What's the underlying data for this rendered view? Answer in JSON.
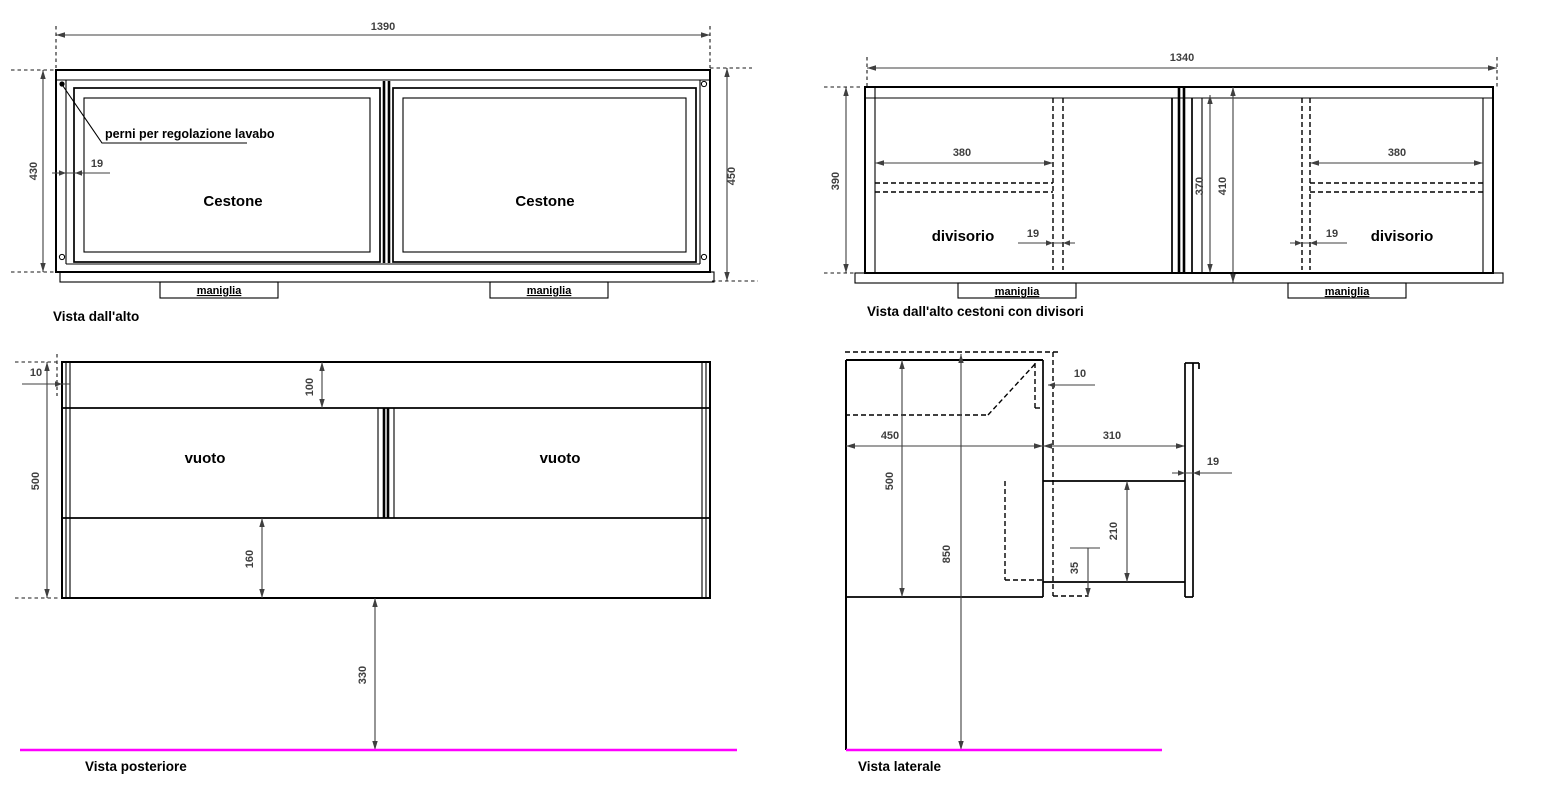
{
  "colors": {
    "line": "#000000",
    "dimension": "#3f3f3f",
    "floor_line": "#ff00ff",
    "background": "#ffffff"
  },
  "views": {
    "top_plan": {
      "title": "Vista dall'alto",
      "note": "perni per regolazione lavabo",
      "drawer_label": "Cestone",
      "handle_label": "maniglia",
      "dims": {
        "overall_width": "1390",
        "depth_inner": "430",
        "depth_outer": "450",
        "panel_thickness": "19"
      }
    },
    "top_plan_dividers": {
      "title": "Vista dall'alto cestoni con divisori",
      "divider_label": "divisorio",
      "handle_label": "maniglia",
      "dims": {
        "overall_width": "1340",
        "depth_left": "390",
        "depth_inner": "370",
        "depth_outer": "410",
        "divider_offset": "380",
        "divider_thickness": "19"
      }
    },
    "rear": {
      "title": "Vista posteriore",
      "empty_label": "vuoto",
      "dims": {
        "back_panel_gap": "10",
        "top_rail_height": "100",
        "carcass_height": "500",
        "bottom_rail_height": "160",
        "height_from_floor": "330"
      }
    },
    "side": {
      "title": "Vista laterale",
      "dims": {
        "top_gap": "10",
        "cabinet_depth": "450",
        "front_clearance": "310",
        "panel_thickness": "19",
        "cabinet_height": "500",
        "worktop_height": "850",
        "drawer_front_height": "210",
        "bottom_gap": "35"
      }
    }
  }
}
